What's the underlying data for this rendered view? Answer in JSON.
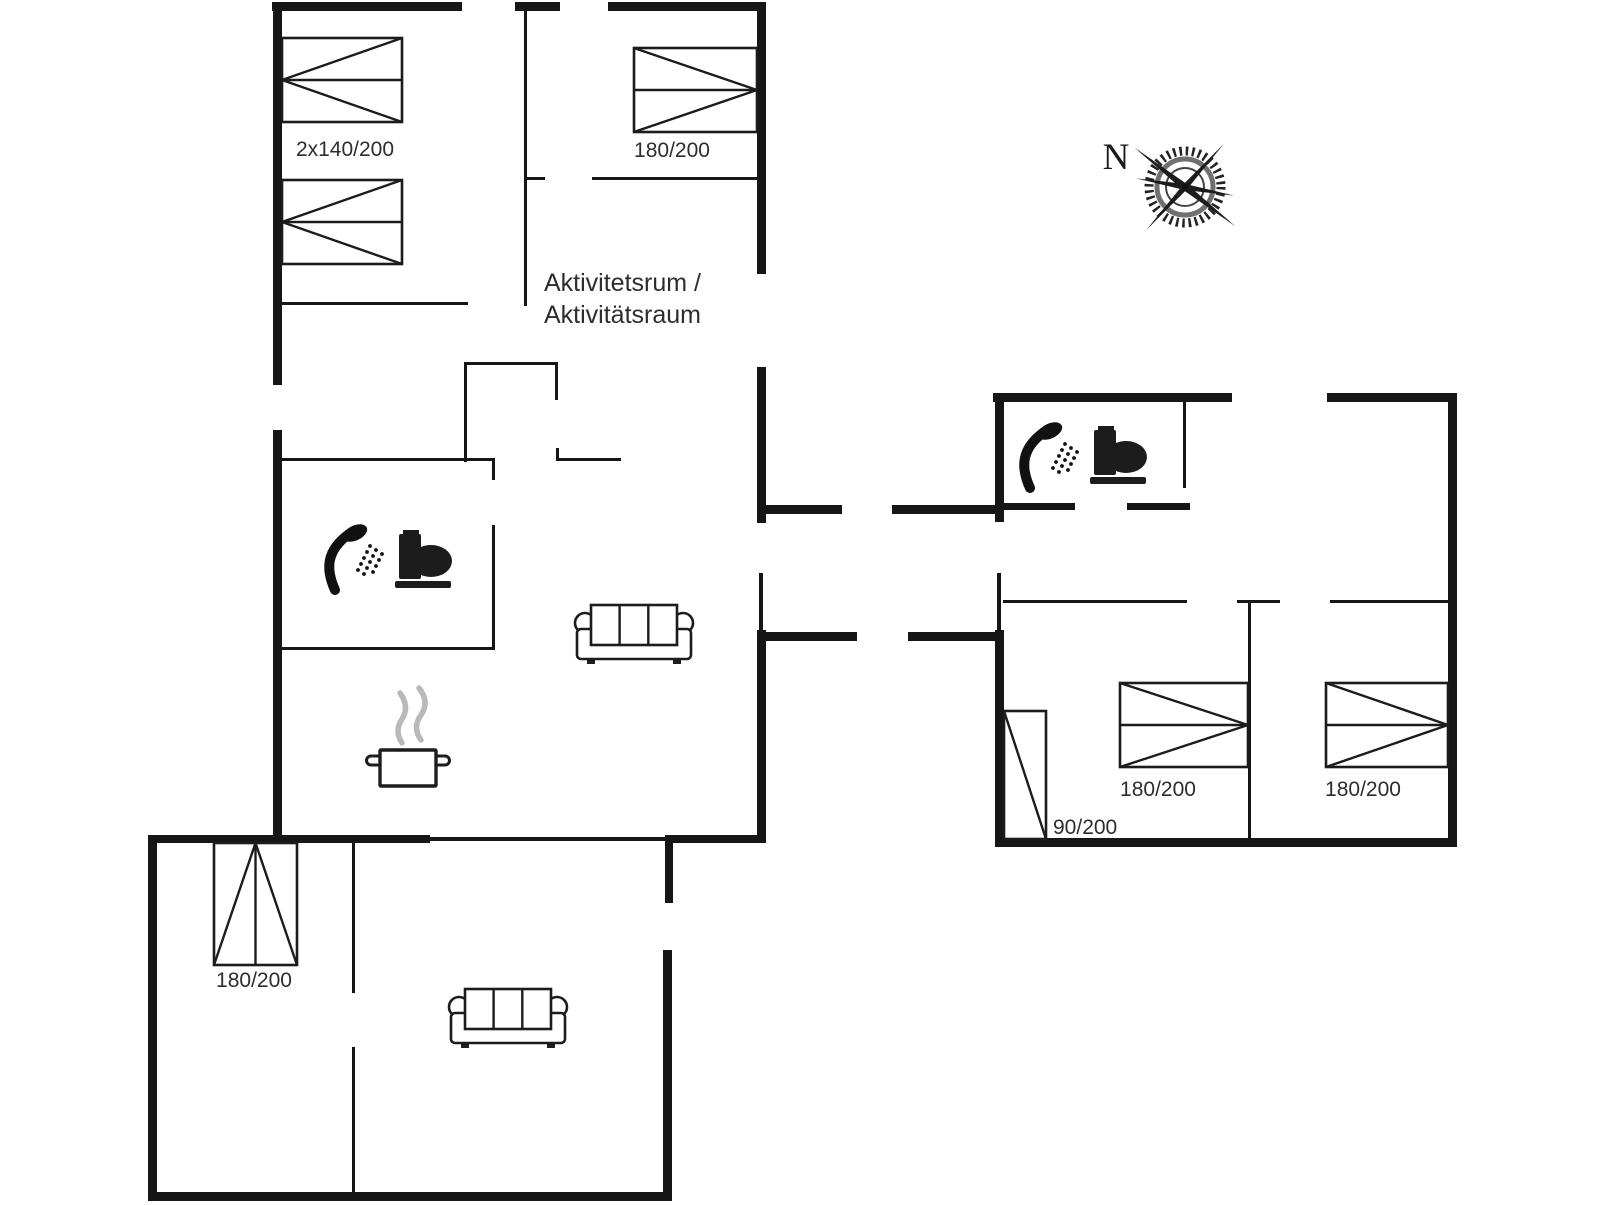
{
  "palette": {
    "wall": "#161616",
    "furniture_stroke": "#1c1c1c",
    "label_text": "#2d2d2d",
    "steam": "#b9b9b9",
    "background": "#ffffff"
  },
  "compass": {
    "north_label": "N"
  },
  "labels": {
    "activity_room_line1": "Aktivitetsrum /",
    "activity_room_line2": "Aktivitätsraum",
    "bed_top_left": "2x140/200",
    "bed_top_middle": "180/200",
    "bed_right_room1": "180/200",
    "bed_right_room2": "180/200",
    "wardrobe_right_wing": "90/200",
    "bed_bottom_wing": "180/200"
  },
  "icons": [
    "shower-icon",
    "toilet-icon",
    "sofa-icon",
    "cooking-pot-icon",
    "compass-rose-icon",
    "bed-icon",
    "wardrobe-icon"
  ]
}
